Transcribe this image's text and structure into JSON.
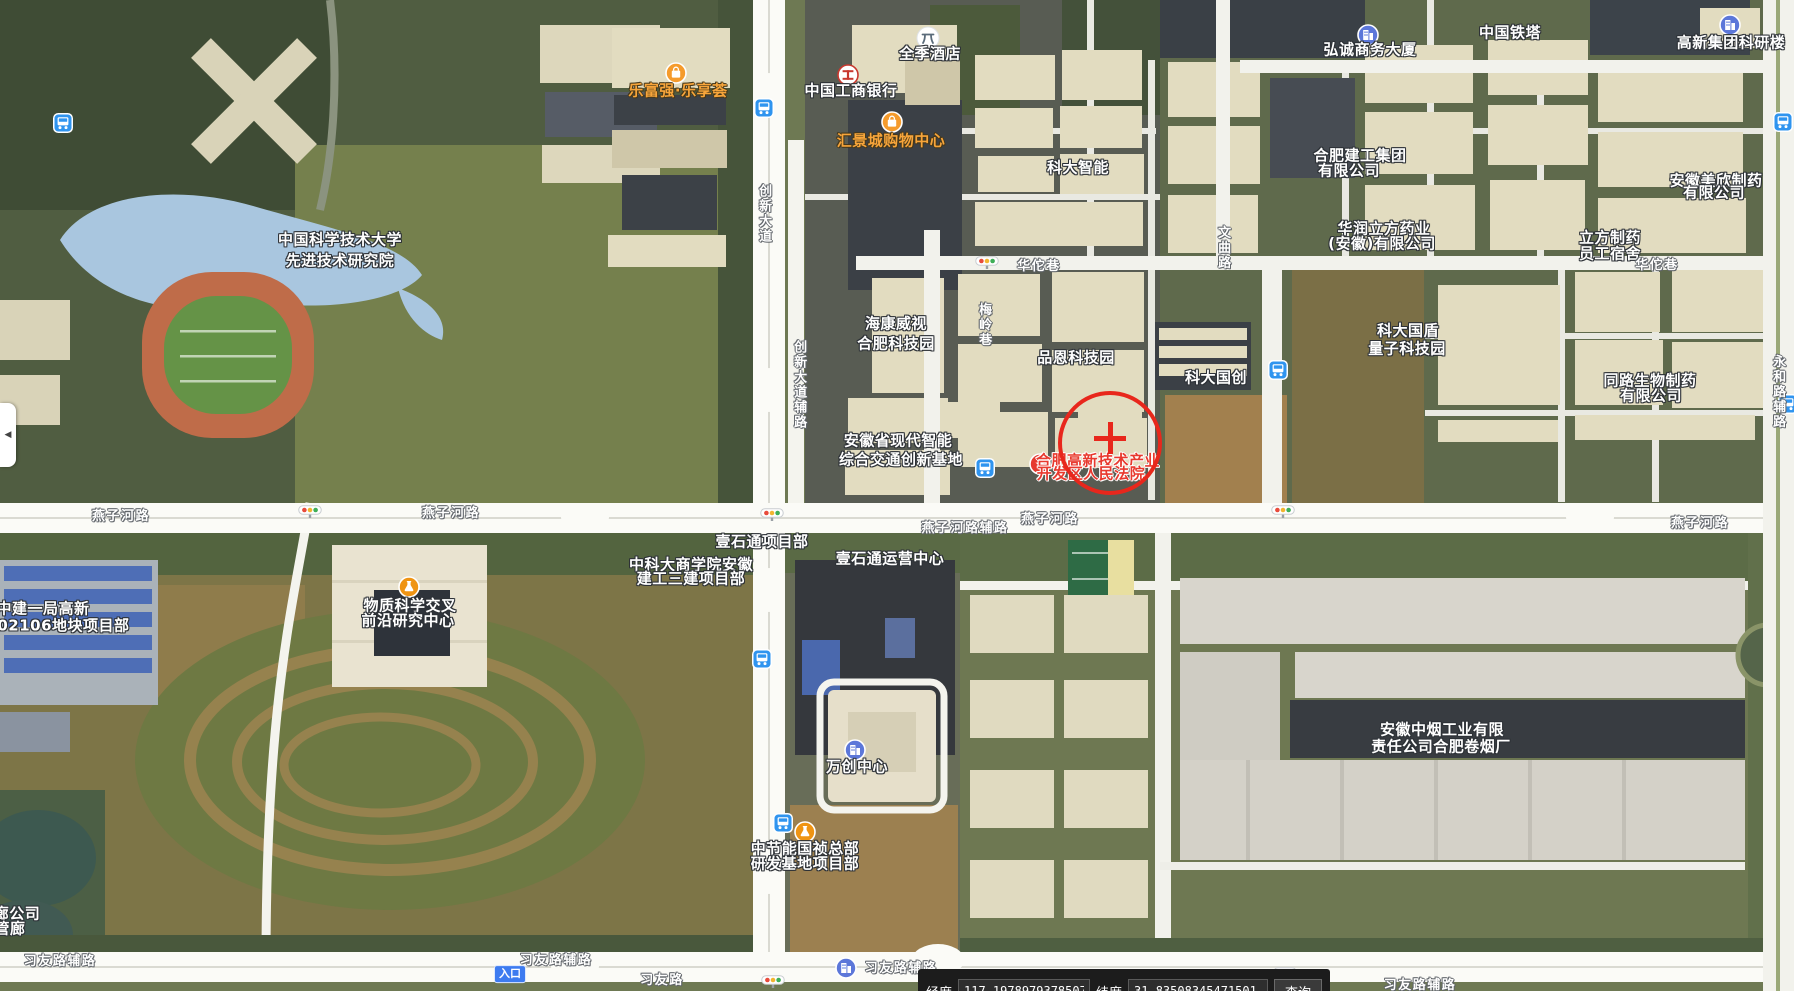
{
  "map": {
    "accent_colors": {
      "poi_text": "#ffffff",
      "shopping_text": "#f7a53b",
      "court_text": "#e8392e",
      "marker_red": "#e8271c",
      "bus_icon_blue": "#2f94ef",
      "building_icon_blue": "#5c77d9",
      "poi_icon_orange": "#f59b2c"
    },
    "labels": [
      {
        "t": "中国科学技术大学",
        "x": 340,
        "y": 240,
        "k": "p"
      },
      {
        "t": "先进技术研究院",
        "x": 340,
        "y": 261,
        "k": "p"
      },
      {
        "t": "全季酒店",
        "x": 930,
        "y": 54,
        "k": "p"
      },
      {
        "t": "中国工商银行",
        "x": 851,
        "y": 91,
        "k": "p"
      },
      {
        "t": "科大智能",
        "x": 1078,
        "y": 168,
        "k": "p"
      },
      {
        "t": "弘诚商务大厦",
        "x": 1370,
        "y": 50,
        "k": "p"
      },
      {
        "t": "中国铁塔",
        "x": 1510,
        "y": 33,
        "k": "p"
      },
      {
        "t": "高新集团科研楼",
        "x": 1731,
        "y": 43,
        "k": "p"
      },
      {
        "t": "合肥建工集团",
        "x": 1360,
        "y": 156,
        "k": "p"
      },
      {
        "t": "有限公司",
        "x": 1349,
        "y": 171,
        "k": "p"
      },
      {
        "t": "华润立方药业",
        "x": 1384,
        "y": 229,
        "k": "p"
      },
      {
        "t": "(安徽)有限公司",
        "x": 1382,
        "y": 244,
        "k": "p"
      },
      {
        "t": "立方制药",
        "x": 1610,
        "y": 238,
        "k": "p"
      },
      {
        "t": "员工宿舍",
        "x": 1610,
        "y": 254,
        "k": "p"
      },
      {
        "t": "安徽美欣制药",
        "x": 1716,
        "y": 181,
        "k": "p"
      },
      {
        "t": "有限公司",
        "x": 1714,
        "y": 193,
        "k": "p"
      },
      {
        "t": "海康威视",
        "x": 896,
        "y": 324,
        "k": "p"
      },
      {
        "t": "合肥科技园",
        "x": 896,
        "y": 344,
        "k": "p"
      },
      {
        "t": "品恩科技园",
        "x": 1076,
        "y": 358,
        "k": "p"
      },
      {
        "t": "科大国创",
        "x": 1216,
        "y": 378,
        "k": "p"
      },
      {
        "t": "安徽省现代智能",
        "x": 898,
        "y": 441,
        "k": "p"
      },
      {
        "t": "综合交通创新基地",
        "x": 901,
        "y": 460,
        "k": "p"
      },
      {
        "t": "科大国盾",
        "x": 1408,
        "y": 331,
        "k": "p"
      },
      {
        "t": "量子科技园",
        "x": 1407,
        "y": 349,
        "k": "p"
      },
      {
        "t": "同路生物制药",
        "x": 1650,
        "y": 381,
        "k": "p"
      },
      {
        "t": "有限公司",
        "x": 1651,
        "y": 396,
        "k": "p"
      },
      {
        "t": "物质科学交叉",
        "x": 410,
        "y": 606,
        "k": "p"
      },
      {
        "t": "前沿研究中心",
        "x": 408,
        "y": 621,
        "k": "p"
      },
      {
        "t": "中建一局高新",
        "x": 43,
        "y": 609,
        "k": "p"
      },
      {
        "t": "202106地块项目部",
        "x": 58,
        "y": 626,
        "k": "p"
      },
      {
        "t": "中科大商学院安徽",
        "x": 691,
        "y": 565,
        "k": "p"
      },
      {
        "t": "建工三建项目部",
        "x": 691,
        "y": 579,
        "k": "p"
      },
      {
        "t": "壹石通项目部",
        "x": 762,
        "y": 542,
        "k": "p"
      },
      {
        "t": "壹石通运营中心",
        "x": 890,
        "y": 559,
        "k": "p"
      },
      {
        "t": "万创中心",
        "x": 857,
        "y": 767,
        "k": "p"
      },
      {
        "t": "中节能国祯总部",
        "x": 805,
        "y": 849,
        "k": "p"
      },
      {
        "t": "研发基地项目部",
        "x": 805,
        "y": 864,
        "k": "p"
      },
      {
        "t": "安徽中烟工业有限",
        "x": 1442,
        "y": 730,
        "k": "p"
      },
      {
        "t": "责任公司合肥卷烟厂",
        "x": 1441,
        "y": 747,
        "k": "p"
      },
      {
        "t": "廊公司",
        "x": 17,
        "y": 914,
        "k": "p"
      },
      {
        "t": "管廊",
        "x": 10,
        "y": 929,
        "k": "p"
      },
      {
        "t": "乐富强·乐享荟",
        "x": 678,
        "y": 91,
        "k": "o"
      },
      {
        "t": "汇景城购物中心",
        "x": 891,
        "y": 141,
        "k": "o"
      },
      {
        "t": "合肥高新技术产业",
        "x": 1098,
        "y": 461,
        "k": "r"
      },
      {
        "t": "开发区人民法院",
        "x": 1091,
        "y": 474,
        "k": "r"
      },
      {
        "t": "燕子河路",
        "x": 121,
        "y": 517,
        "k": "rd"
      },
      {
        "t": "燕子河路",
        "x": 451,
        "y": 514,
        "k": "rd"
      },
      {
        "t": "燕子河路",
        "x": 1050,
        "y": 520,
        "k": "rd"
      },
      {
        "t": "燕子河路",
        "x": 1700,
        "y": 524,
        "k": "rd"
      },
      {
        "t": "燕子河路辅路",
        "x": 965,
        "y": 529,
        "k": "rd"
      },
      {
        "t": "习友路辅路",
        "x": 60,
        "y": 962,
        "k": "rd"
      },
      {
        "t": "习友路辅路",
        "x": 556,
        "y": 961,
        "k": "rd"
      },
      {
        "t": "习友路辅路",
        "x": 901,
        "y": 969,
        "k": "rd"
      },
      {
        "t": "习友路",
        "x": 662,
        "y": 981,
        "k": "rd"
      },
      {
        "t": "习友路辅路",
        "x": 1420,
        "y": 986,
        "k": "rd"
      },
      {
        "t": "华佗巷",
        "x": 1039,
        "y": 267,
        "k": "rd"
      },
      {
        "t": "华佗巷",
        "x": 1657,
        "y": 266,
        "k": "rd"
      },
      {
        "t": "创新大道",
        "x": 763,
        "y": 214,
        "k": "v"
      },
      {
        "t": "创新大道辅路",
        "x": 798,
        "y": 385,
        "k": "v"
      },
      {
        "t": "梅岭巷",
        "x": 983,
        "y": 325,
        "k": "v"
      },
      {
        "t": "文曲路",
        "x": 1222,
        "y": 248,
        "k": "v"
      },
      {
        "t": "永和路辅路",
        "x": 1777,
        "y": 392,
        "k": "v"
      },
      {
        "t": "入口",
        "x": 510,
        "y": 974,
        "k": "b"
      }
    ],
    "icons": [
      {
        "k": "bus",
        "x": 63,
        "y": 123
      },
      {
        "k": "bus",
        "x": 764,
        "y": 108
      },
      {
        "k": "bus",
        "x": 985,
        "y": 468
      },
      {
        "k": "bus",
        "x": 1278,
        "y": 370
      },
      {
        "k": "bus",
        "x": 1783,
        "y": 122
      },
      {
        "k": "bus",
        "x": 1788,
        "y": 404
      },
      {
        "k": "bus",
        "x": 762,
        "y": 659
      },
      {
        "k": "bus",
        "x": 783,
        "y": 823
      },
      {
        "k": "traffic",
        "x": 310,
        "y": 512
      },
      {
        "k": "traffic",
        "x": 772,
        "y": 515
      },
      {
        "k": "traffic",
        "x": 987,
        "y": 263
      },
      {
        "k": "traffic",
        "x": 1283,
        "y": 512
      },
      {
        "k": "traffic",
        "x": 773,
        "y": 982
      },
      {
        "k": "traffic",
        "x": 1285,
        "y": 974
      },
      {
        "k": "building",
        "x": 1368,
        "y": 35
      },
      {
        "k": "building",
        "x": 1730,
        "y": 25
      },
      {
        "k": "building",
        "x": 855,
        "y": 750
      },
      {
        "k": "building",
        "x": 846,
        "y": 968
      },
      {
        "k": "shopping",
        "x": 676,
        "y": 73
      },
      {
        "k": "shopping",
        "x": 892,
        "y": 122
      },
      {
        "k": "flask",
        "x": 409,
        "y": 587
      },
      {
        "k": "flask",
        "x": 805,
        "y": 832
      },
      {
        "k": "star",
        "x": 1040,
        "y": 464
      },
      {
        "k": "hotel",
        "x": 928,
        "y": 38
      },
      {
        "k": "bank",
        "x": 848,
        "y": 75
      }
    ],
    "marker": {
      "cx": 1110,
      "cy": 443,
      "radius": 52,
      "cross_x": 1110,
      "cross_y": 438
    }
  },
  "sidebar_toggle": {
    "glyph": "◀"
  },
  "statusbar": {
    "lon_label": "经度",
    "lon_value": "117.1978979378507",
    "lat_label": "纬度",
    "lat_value": "31.83508345471501",
    "query_label": "查询"
  }
}
